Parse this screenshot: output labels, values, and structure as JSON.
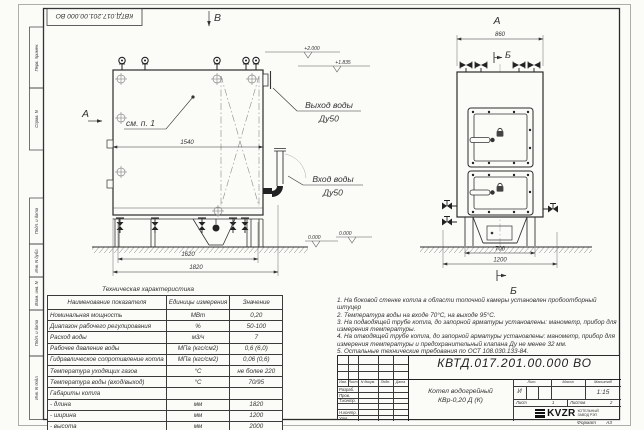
{
  "sheet": {
    "stamp": "КВТД.017.201.00.000 ВО",
    "format_label": "Формат",
    "format_value": "А3",
    "side_fields": [
      "Перв. примен.",
      "Справ. N",
      "Подп. и дата",
      "Инв. N дубл.",
      "Взам. инв. N",
      "Подп. и дата",
      "Инв. N подл."
    ]
  },
  "front_view": {
    "marker_top": "В",
    "marker_left": "А",
    "callout": "см. п. 1",
    "dim_inner": "1540",
    "dim_mid": "1620",
    "dim_outer": "1820",
    "outlet_label": "Выход воды",
    "outlet_dn": "Ду50",
    "inlet_label": "Вход воды",
    "inlet_dn": "Ду50",
    "elev_top": "+2.000",
    "elev_mid": "+1.835",
    "elev_zero": "0.000"
  },
  "side_view": {
    "marker_top": "А",
    "dim_top": "860",
    "marker_section_top": "Б",
    "marker_section_bottom": "Б",
    "dim_inner": "700",
    "dim_outer": "1200",
    "elev_zero": "0.000"
  },
  "notes": [
    "1. На боковой стенке котла в области топочной камеры установлен пробоотборный штуцер",
    "2. Температура воды на входе 70°С, на выходе 95°С.",
    "3. На подводящей трубе котла, до запорной арматуры установлены: манометр, прибор для измерения температуры.",
    "4. На отводящей трубе котла, до запорной арматуры установлены: манометр, прибор для измерения температуры и предохранительный клапана Ду не менее 32 мм.",
    "5. Остальные технические требования по ОСТ 108.030.133-84."
  ],
  "tech_table": {
    "title": "Техническая характеристика",
    "headers": [
      "Наименование показателя",
      "Единицы измерения",
      "Значение"
    ],
    "rows": [
      {
        "name": "Номинальная мощность",
        "unit": "МВт",
        "value": "0,20"
      },
      {
        "name": "Диапазон рабочего регулирования",
        "unit": "%",
        "value": "50-100"
      },
      {
        "name": "Расход воды",
        "unit": "м3/ч",
        "value": "7"
      },
      {
        "name": "Рабочее давление воды",
        "unit": "МПа (кгс/см2)",
        "value": "0,6 (6,0)"
      },
      {
        "name": "Гидравлическое сопротивление котла",
        "unit": "МПа (кгс/см2)",
        "value": "0,06 (0,6)"
      },
      {
        "name": "Температура уходящих газов",
        "unit": "°С",
        "value": "не более 220"
      },
      {
        "name": "Температура воды (вход/выход)",
        "unit": "°С",
        "value": "70/95"
      },
      {
        "name": "Габариты котла",
        "unit": "",
        "value": ""
      },
      {
        "name": "- длина",
        "unit": "мм",
        "value": "1820"
      },
      {
        "name": "- ширина",
        "unit": "мм",
        "value": "1200"
      },
      {
        "name": "- высота",
        "unit": "мм",
        "value": "2000"
      }
    ]
  },
  "title_block": {
    "doc_number": "КВТД.017.201.00.000 ВО",
    "product_line1": "Котел водогрейный",
    "product_line2": "КВр-0,20 Д (К)",
    "rev_headers": [
      "Изм.",
      "Лист",
      "N докум.",
      "Подп.",
      "Дата"
    ],
    "staff": [
      "Разраб.",
      "Пров.",
      "Т.контр.",
      "",
      "Н.контр.",
      "Утв."
    ],
    "lit_label": "Лит.",
    "mass_label": "Масса",
    "scale_label": "Масштаб",
    "lit_value": "И",
    "scale_value": "1:15",
    "sheet_label": "Лист",
    "sheet_value": "1",
    "sheets_label": "Листов",
    "sheets_value": "2",
    "logo_text": "KVZR",
    "logo_sub1": "КОТЕЛЬНЫЙ",
    "logo_sub2": "ЗАВОД РЭП"
  }
}
